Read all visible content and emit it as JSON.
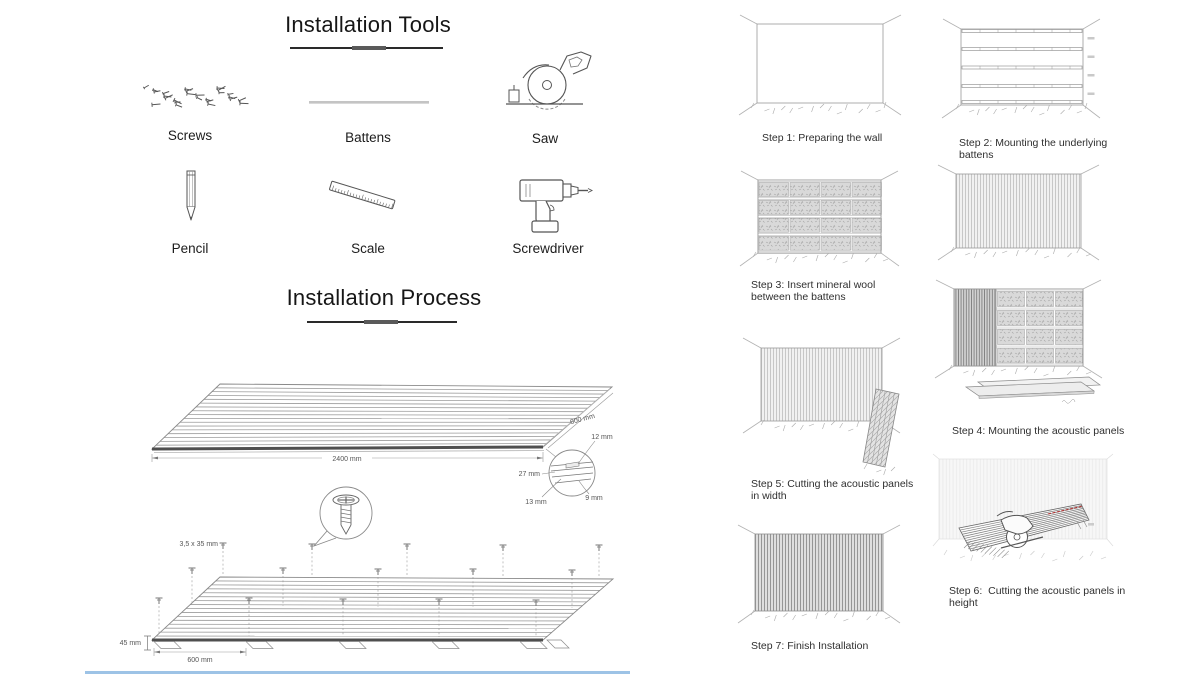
{
  "canvas": {
    "width": 1200,
    "height": 675,
    "background": "#ffffff"
  },
  "tools_section": {
    "title": "Installation Tools",
    "tools": [
      {
        "name": "Screws",
        "icon": "screws-icon"
      },
      {
        "name": "Battens",
        "icon": "battens-icon"
      },
      {
        "name": "Saw",
        "icon": "saw-icon"
      },
      {
        "name": "Pencil",
        "icon": "pencil-icon"
      },
      {
        "name": "Scale",
        "icon": "scale-icon"
      },
      {
        "name": "Screwdriver",
        "icon": "screwdriver-icon"
      }
    ]
  },
  "process_section": {
    "title": "Installation Process",
    "panel_diagram": {
      "length": "2400 mm",
      "width": "600 mm",
      "slat_width": "12 mm",
      "total_thickness": "27 mm",
      "base_thickness": "9 mm",
      "slat_depth": "13 mm"
    },
    "mounting_diagram": {
      "screw_size": "3,5 x 35 mm",
      "batten_height": "45 mm",
      "batten_spacing": "600 mm"
    }
  },
  "steps": [
    {
      "id": 1,
      "label": "Step 1: Preparing the wall"
    },
    {
      "id": 2,
      "label": "Step 2: Mounting the underlying battens"
    },
    {
      "id": 3,
      "label": "Step 3: Insert mineral wool between the battens"
    },
    {
      "id": 4,
      "label": "Step 4: Mounting the acoustic panels"
    },
    {
      "id": 5,
      "label": "Step 5: Cutting the acoustic panels in width"
    },
    {
      "id": 6,
      "label": "Step 6:  Cutting the acoustic panels in height"
    },
    {
      "id": 7,
      "label": "Step 7: Finish Installation"
    }
  ],
  "colors": {
    "line_art": "#8a8a8a",
    "text": "#2f2f2f",
    "cut_mark_red": "#b03434",
    "accent_blue_line": "#9dc3e6"
  }
}
